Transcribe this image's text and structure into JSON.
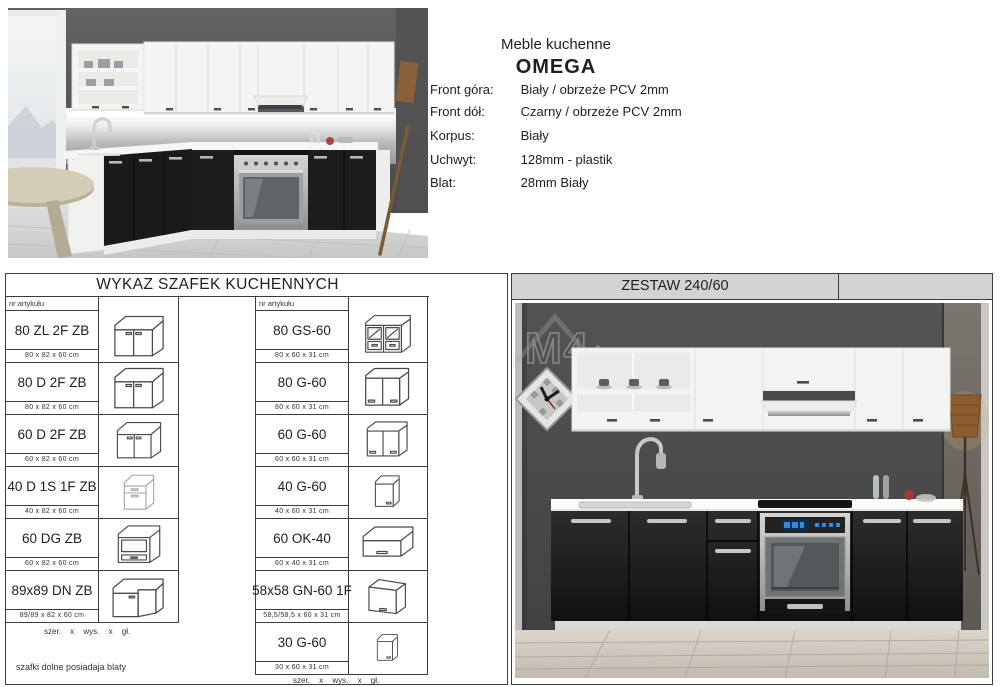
{
  "header": {
    "title_line1": "Meble kuchenne",
    "title_line2": "OMEGA",
    "specs": [
      {
        "label": "Front góra:",
        "value": "Biały / obrzeże PCV 2mm"
      },
      {
        "label": "Front dół:",
        "value": "Czarny / obrzeże PCV 2mm"
      },
      {
        "label": "Korpus:",
        "value": "Biały"
      },
      {
        "label": "Uchwyt:",
        "value": "128mm - plastik"
      },
      {
        "label": "Blat:",
        "value": "28mm Biały"
      }
    ]
  },
  "cabinet_list": {
    "title": "WYKAZ SZAFEK KUCHENNYCH",
    "col_header": "nr artykułu",
    "left": [
      {
        "code": "80 ZL 2F ZB",
        "dims": "80 x 82 x 60 cm",
        "icon": "base-sink-2door-cabinet-icon"
      },
      {
        "code": "80 D 2F ZB",
        "dims": "80 x 82 x 60 cm",
        "icon": "base-2door-cabinet-icon"
      },
      {
        "code": "60 D 2F ZB",
        "dims": "60 x 82 x 60 cm",
        "icon": "base-2door-cabinet-icon"
      },
      {
        "code": "40 D 1S 1F ZB",
        "dims": "40 x 82 x 60 cm",
        "icon": "base-drawer-door-cabinet-icon"
      },
      {
        "code": "60 DG ZB",
        "dims": "60 x 82 x 60 cm",
        "icon": "base-oven-housing-cabinet-icon"
      },
      {
        "code": "89x89 DN ZB",
        "dims": "89/89 x 82 x 60 cm",
        "icon": "base-corner-cabinet-icon"
      }
    ],
    "left_footnote": "szer. x wys. x gł.",
    "left_note": "szafki dolne posiadaja blaty",
    "right": [
      {
        "code": "80 GS-60",
        "dims": "80 x 60 x 31 cm",
        "icon": "wall-glass-cabinet-icon"
      },
      {
        "code": "80 G-60",
        "dims": "80 x 60 x 31 cm",
        "icon": "wall-2door-cabinet-icon"
      },
      {
        "code": "60 G-60",
        "dims": "60 x 60 x 31 cm",
        "icon": "wall-2door-cabinet-icon"
      },
      {
        "code": "40 G-60",
        "dims": "40 x 60 x 31 cm",
        "icon": "wall-1door-cabinet-icon"
      },
      {
        "code": "60 OK-40",
        "dims": "60 x 40 x 31 cm",
        "icon": "wall-flap-cabinet-icon"
      },
      {
        "code": "58x58 GN-60 1F",
        "dims": "58,5/58,5 x 60 x 31 cm",
        "icon": "wall-corner-cabinet-icon"
      },
      {
        "code": "30 G-60",
        "dims": "30 x 60 x 31 cm",
        "icon": "wall-1door-narrow-cabinet-icon"
      }
    ],
    "right_footnote": "szer. x wys. x gł."
  },
  "set_panel": {
    "title": "ZESTAW 240/60",
    "watermark": {
      "text": "M4",
      "suffix": ".pl"
    }
  },
  "colors": {
    "border": "#3c3c3c",
    "panel_header_bg": "#d3d3d3",
    "wall_gray": "#4f4f51",
    "cabinet_front_dark": "#1a1a1a",
    "cabinet_front_white": "#f5f5f3"
  }
}
